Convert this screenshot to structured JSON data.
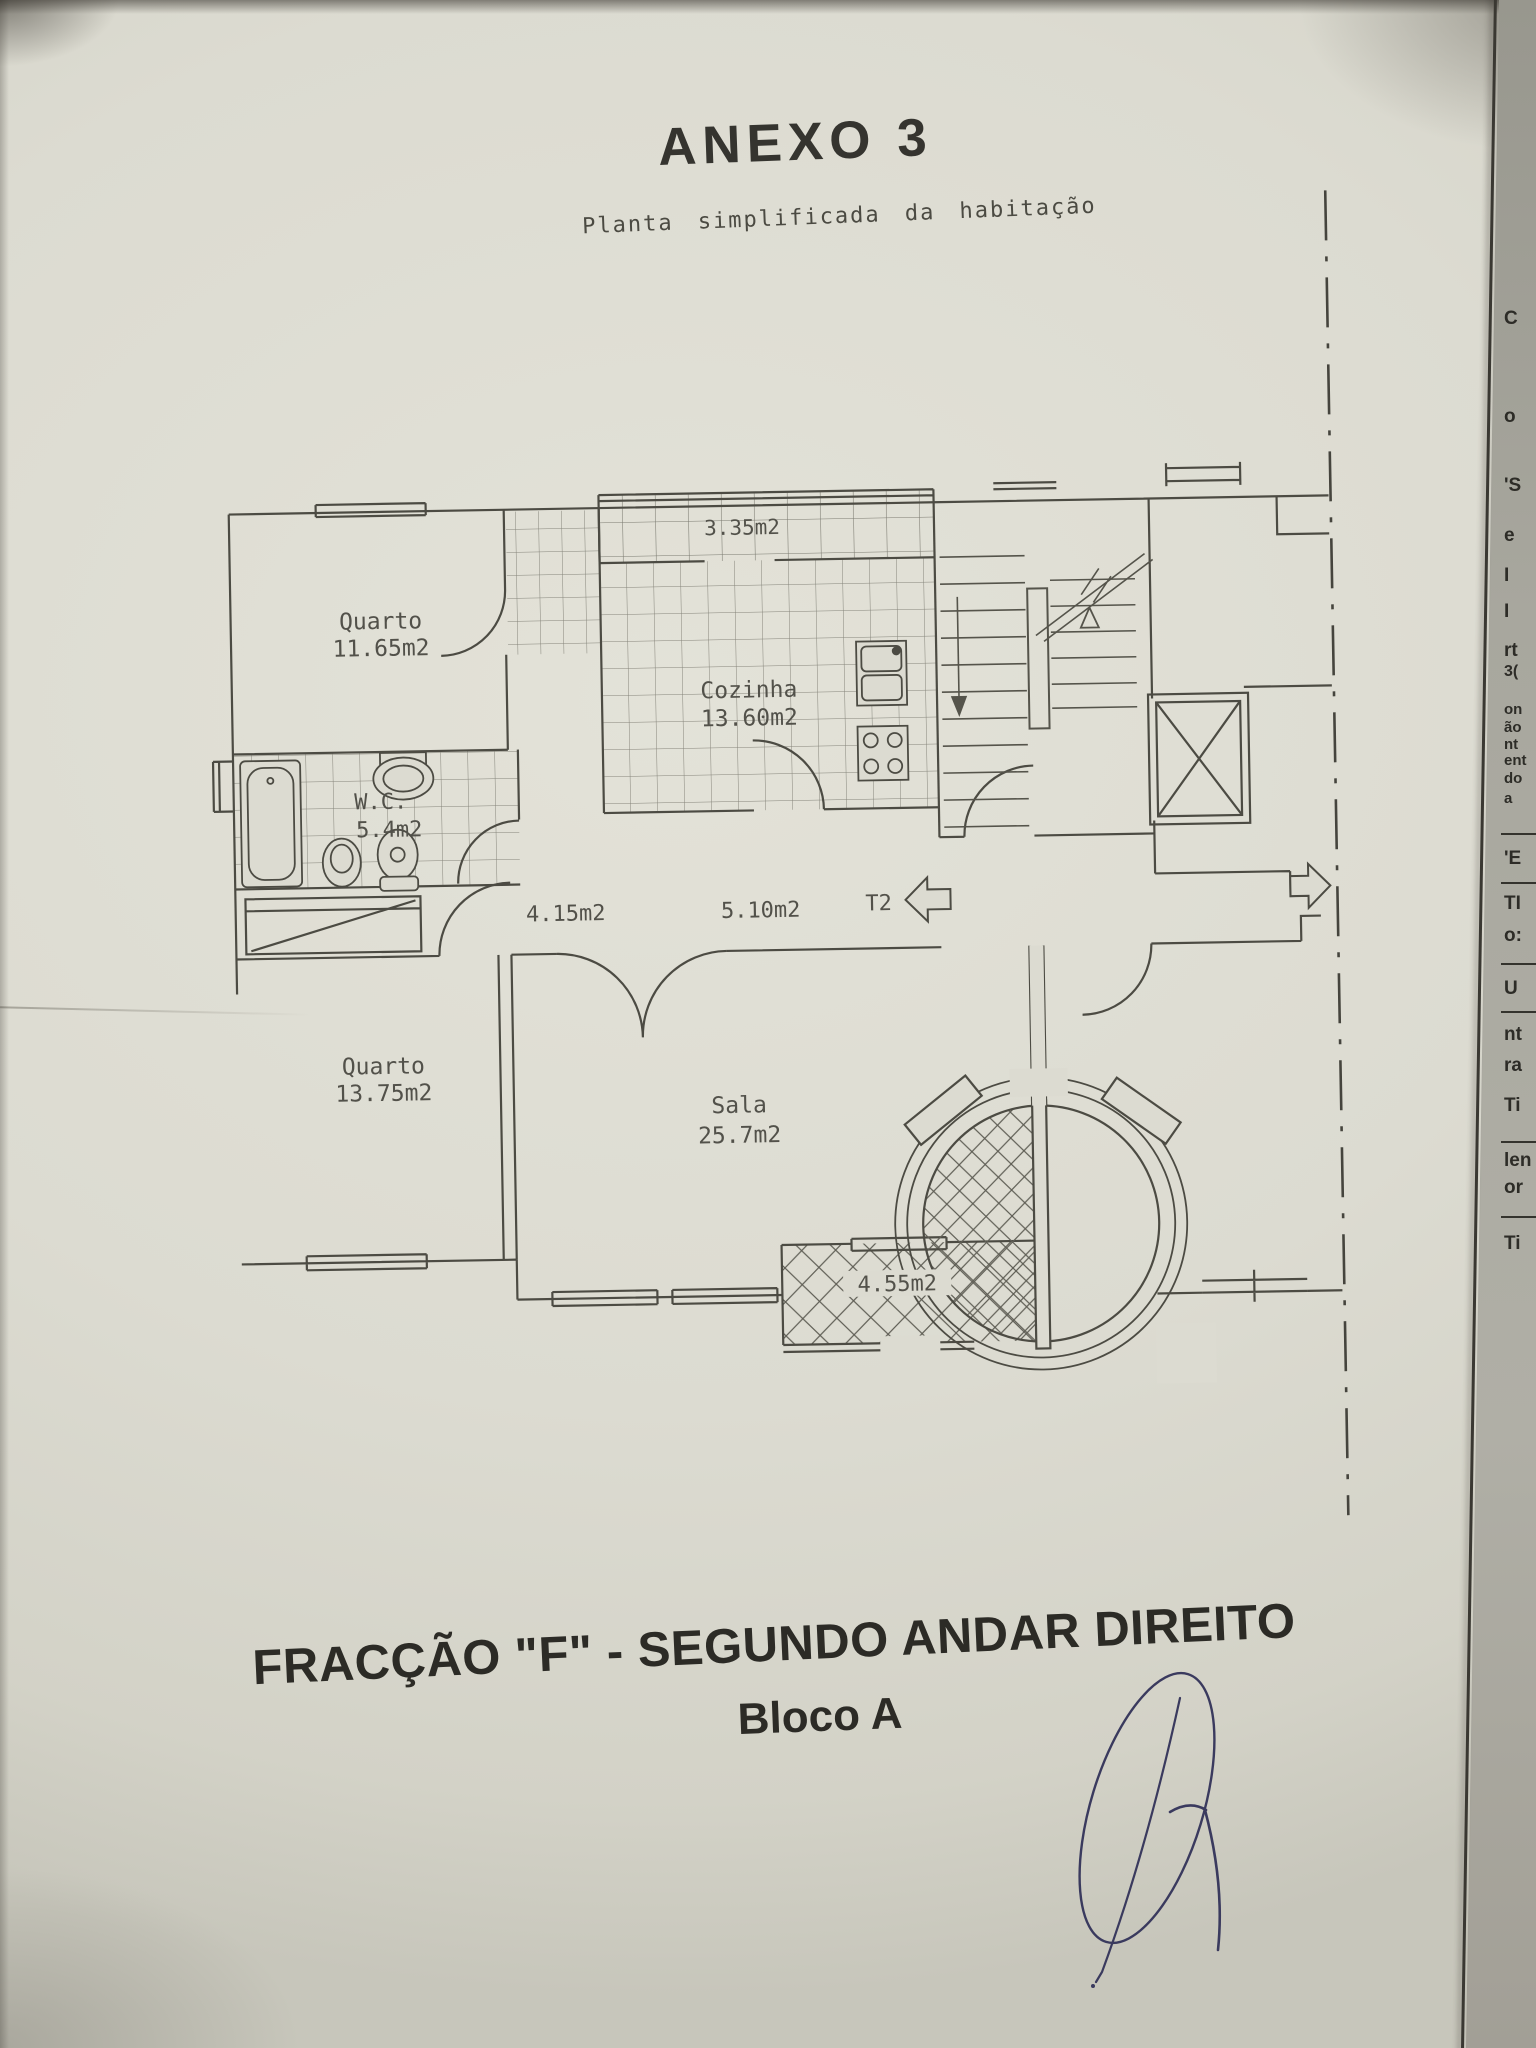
{
  "document": {
    "title": "ANEXO 3",
    "subtitle": "Planta simplificada da habitação",
    "footer_title": "FRACÇÃO  \"F\" - SEGUNDO ANDAR DIREITO",
    "footer_subtitle": "Bloco A"
  },
  "floor_plan": {
    "entrance_type_label": "T2",
    "rooms": [
      {
        "name": "Quarto",
        "area": "11.65m2"
      },
      {
        "name": "Cozinha",
        "area": "13.60m2"
      },
      {
        "name": "W.C.",
        "area": "5.4m2"
      },
      {
        "name": "Quarto",
        "area": "13.75m2"
      },
      {
        "name": "Sala",
        "area": "25.7m2"
      }
    ],
    "balcony_top_area": "3.35m2",
    "hall_area": "4.15m2",
    "corridor_area": "5.10m2",
    "balcony_bottom_area": "4.55m2"
  },
  "side_sheet": {
    "fragments": [
      {
        "text": "C"
      },
      {
        "text": "o"
      },
      {
        "text": "'S"
      },
      {
        "text": "e"
      },
      {
        "text": "I"
      },
      {
        "text": "I"
      },
      {
        "text": "rt"
      },
      {
        "text": "3("
      },
      {
        "text": "on"
      },
      {
        "text": "ão"
      },
      {
        "text": "nt"
      },
      {
        "text": "ent"
      },
      {
        "text": "do"
      },
      {
        "text": "a"
      },
      {
        "text": "'E"
      },
      {
        "text": "TI"
      },
      {
        "text": "o:"
      },
      {
        "text": "U"
      },
      {
        "text": "nt"
      },
      {
        "text": "ra"
      },
      {
        "text": "Ti"
      },
      {
        "text": "len"
      },
      {
        "text": "or"
      },
      {
        "text": "Ti"
      }
    ]
  }
}
